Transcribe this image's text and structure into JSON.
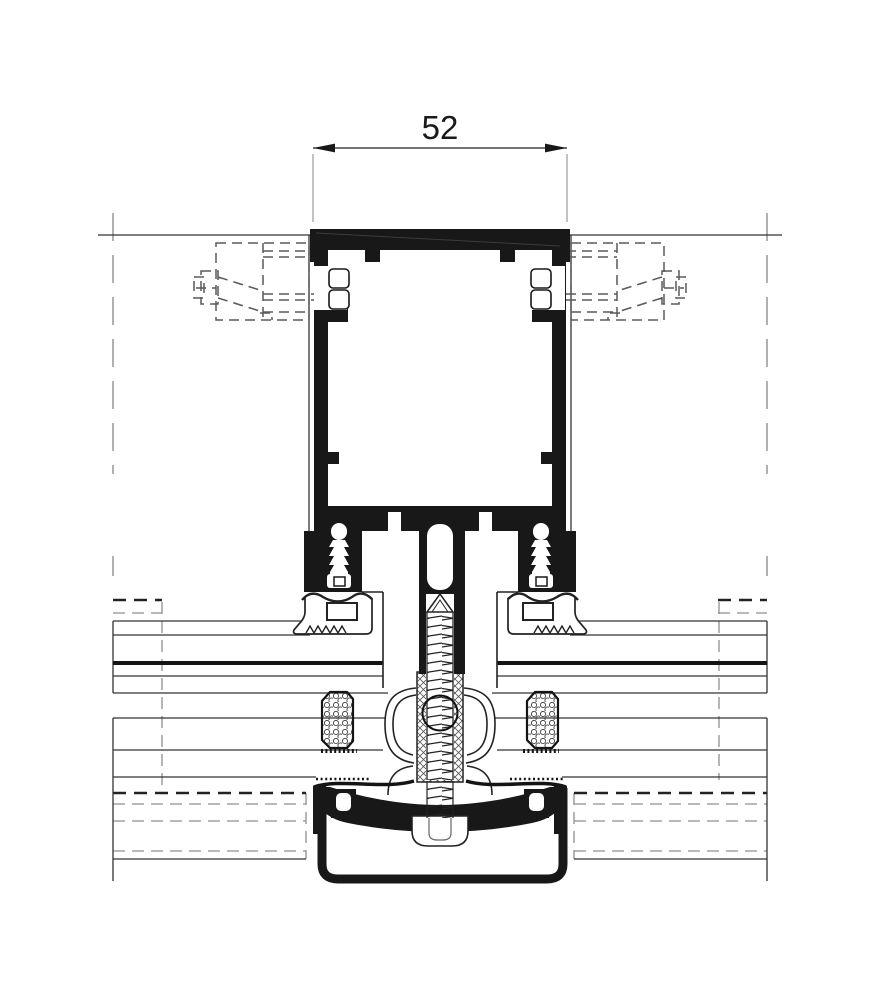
{
  "dimension": {
    "value": "52"
  },
  "colors": {
    "ink": "#181818",
    "line": "#333333",
    "hidden_gray": "#8f8f8f",
    "hidden_anchor": "#5a5a5a",
    "background": "#ffffff"
  }
}
